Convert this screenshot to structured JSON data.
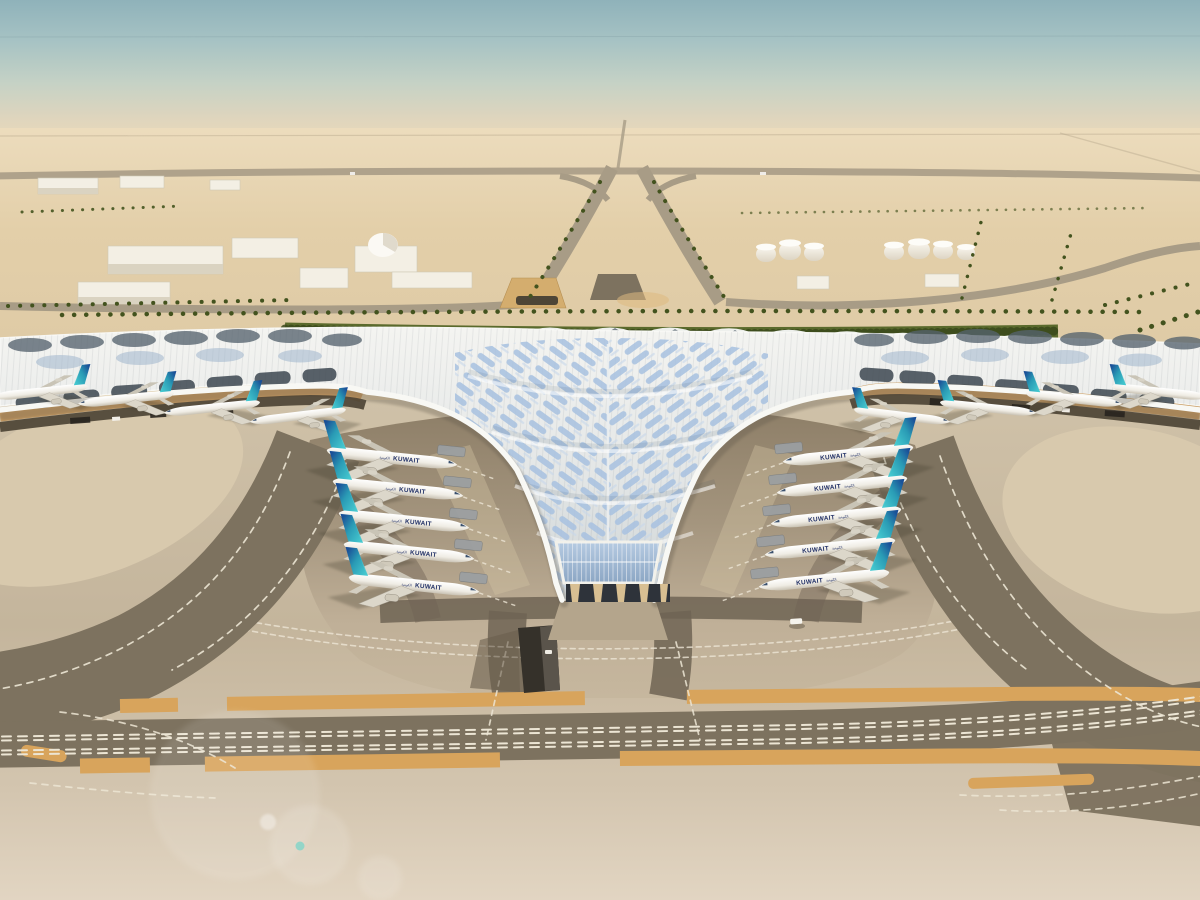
{
  "description": "Aerial daytime rendering of a desert airport: a vast trefoil-shaped terminal with a rippled silver-blue roof, Kuwait Airways jets parked nose-in along the central V, palm-lined approach roads and taxiways with orange shoulder stripes.",
  "airline": {
    "title_en": "KUWAIT",
    "title_ar": "الكويتية"
  },
  "aircraft_counts": {
    "parked_inner_left": 5,
    "parked_inner_right": 5,
    "parked_outer_left": 4,
    "parked_outer_right": 4
  },
  "palette": {
    "sky-top": "#8fb2ba",
    "haze": "#e8d9bc",
    "sand": "#e0cca7",
    "sand-low": "#c4b59c",
    "apron-light": "#c2b39a",
    "apron-dark": "#8a7c66",
    "asphalt": "#7d725f",
    "asphalt-dark": "#6e6453",
    "roof-light": "#f3f3f0",
    "roof-mid": "#dfe3e4",
    "skylight-blue": "#a9c2e0",
    "glass-dark": "#4a5662",
    "fascia-white": "#f8f8f4",
    "soffit-gold": "#c89a5e",
    "hedge-green": "#5a6a2c",
    "palm-green": "#43531e",
    "tail-teal": "#3cc0c9",
    "tail-navy": "#1a4f97",
    "title-navy": "#223167",
    "marking-white": "#ece5d4",
    "marking-orange": "#d8a45c",
    "flare-teal": "#7fd4c8"
  }
}
